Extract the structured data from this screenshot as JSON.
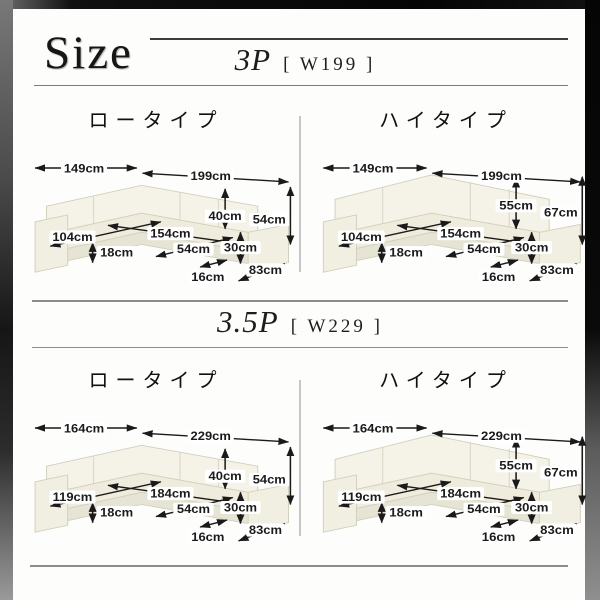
{
  "page": {
    "title": "Size"
  },
  "colors": {
    "sofa_ivory": "#f5f3e8",
    "dimension_ink": "#1a1a1a",
    "frame_black": "#0a0a0a",
    "divider_gray": "#c6c6c6"
  },
  "sections": [
    {
      "heading": "3P",
      "size_label": "[ W199 ]",
      "panels": [
        {
          "title": "ロータイプ",
          "dims": {
            "width_left": "149cm",
            "width_right": "199cm",
            "depth_left": "104cm",
            "inner_width": "154cm",
            "seat_height": "18cm",
            "back_height": "40cm",
            "seat_depth": "54cm",
            "total_height": "54cm",
            "arm_height": "30cm",
            "arm_width": "16cm",
            "depth_right": "83cm"
          }
        },
        {
          "title": "ハイタイプ",
          "dims": {
            "width_left": "149cm",
            "width_right": "199cm",
            "depth_left": "104cm",
            "inner_width": "154cm",
            "seat_height": "18cm",
            "back_height": "55cm",
            "seat_depth": "54cm",
            "total_height": "67cm",
            "arm_height": "30cm",
            "arm_width": "16cm",
            "depth_right": "83cm"
          }
        }
      ]
    },
    {
      "heading": "3.5P",
      "size_label": "[ W229 ]",
      "panels": [
        {
          "title": "ロータイプ",
          "dims": {
            "width_left": "164cm",
            "width_right": "229cm",
            "depth_left": "119cm",
            "inner_width": "184cm",
            "seat_height": "18cm",
            "back_height": "40cm",
            "seat_depth": "54cm",
            "total_height": "54cm",
            "arm_height": "30cm",
            "arm_width": "16cm",
            "depth_right": "83cm"
          }
        },
        {
          "title": "ハイタイプ",
          "dims": {
            "width_left": "164cm",
            "width_right": "229cm",
            "depth_left": "119cm",
            "inner_width": "184cm",
            "seat_height": "18cm",
            "back_height": "55cm",
            "seat_depth": "54cm",
            "total_height": "67cm",
            "arm_height": "30cm",
            "arm_width": "16cm",
            "depth_right": "83cm"
          }
        }
      ]
    }
  ]
}
